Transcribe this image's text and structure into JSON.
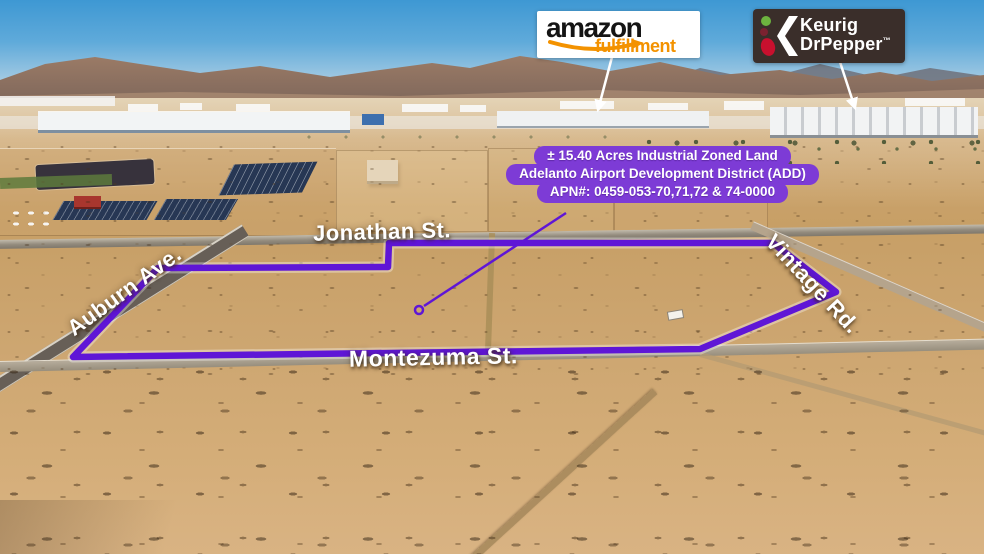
{
  "logos": {
    "amazon": {
      "name": "amazon",
      "tagline": "fulfillment",
      "smile_color": "#f39200"
    },
    "keurig": {
      "line1": "Keurig",
      "line2": "DrPepper",
      "tm": "™",
      "bg": "#3a2e2a"
    }
  },
  "info_badge": {
    "line1": "± 15.40 Acres Industrial Zoned Land",
    "line2": "Adelanto Airport Development District (ADD)",
    "line3": "APN#: 0459-053-70,71,72 & 74-0000",
    "bg": "#7d3bd6",
    "text_color": "#ffffff"
  },
  "street_labels": {
    "jonathan": "Jonathan St.",
    "auburn": "Auburn Ave.",
    "montezuma": "Montezuma St.",
    "vintage": "Vintage Rd."
  },
  "boundary": {
    "color": "#5f16d6",
    "points": "158,268 388,267 389,243 773,243 836,292 700,349 73,357",
    "pointer_line": {
      "x1": 566,
      "y1": 213,
      "x2": 424,
      "y2": 306
    },
    "pointer_dot": {
      "cx": 419,
      "cy": 310
    }
  },
  "callout_lines": {
    "color": "#ffffff",
    "amazon": {
      "x1": 612,
      "y1": 57,
      "x2": 598,
      "y2": 110
    },
    "keurig": {
      "x1": 840,
      "y1": 62,
      "x2": 855,
      "y2": 108
    }
  }
}
